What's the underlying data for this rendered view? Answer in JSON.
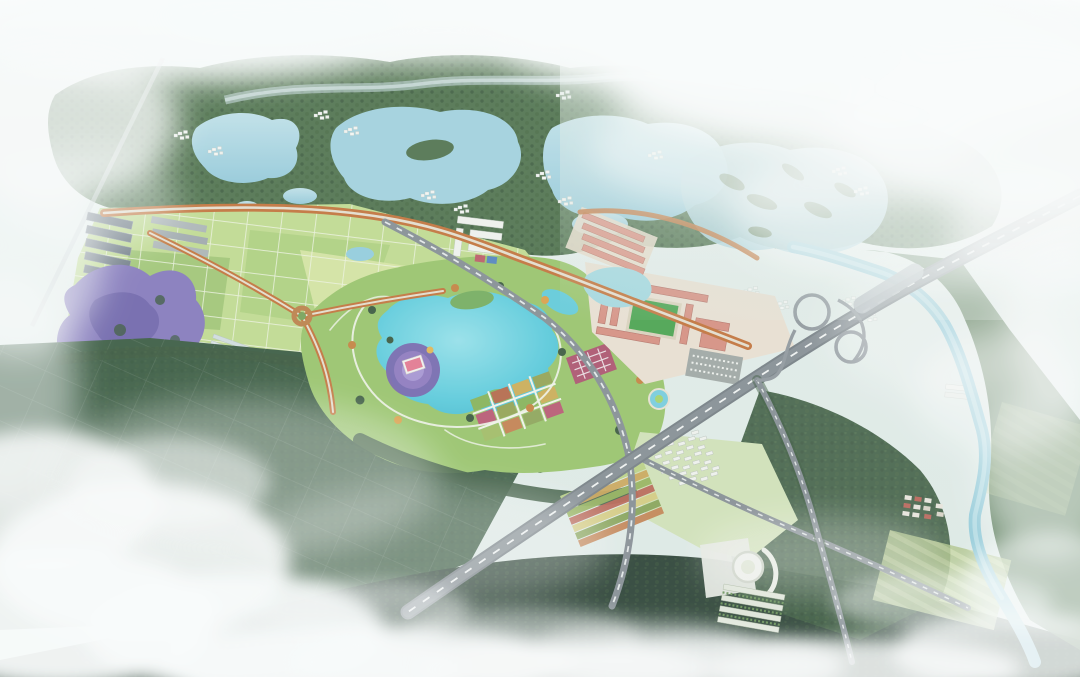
{
  "image": {
    "kind": "aerial-masterplan-rendering",
    "width": 1080,
    "height": 677,
    "visible_text": "none"
  },
  "palette": {
    "sky": "#e3eeea",
    "mist": "#f2f7f5",
    "cloud": "#fbfdfd",
    "forest": "#466b44",
    "forest_dark": "#2f4f33",
    "forest_light": "#679454",
    "field_light": "#bdd98a",
    "field_mid": "#a5ca74",
    "field_dark": "#2e5136",
    "lake_upper": "#9ccfdd",
    "lake_park": "#45c2d6",
    "river": "#8fc9d8",
    "road_gray": "#7e878d",
    "road_light": "#aeb6b8",
    "road_dash": "#f0f3f2",
    "tree_orange": "#bf6b2f",
    "plaza_purple": "#6f5ba8",
    "roof_pink": "#e2708a",
    "campus_roof": "#d4897a",
    "sports_green": "#3f9e44",
    "lavender": "#7e72b8",
    "building_white": "#eff1ed",
    "building_slate": "#67737e",
    "garden_red": "#a84a66",
    "garden_tan": "#c9a84c"
  },
  "scene": {
    "regions": [
      {
        "id": "mist-top",
        "label": "fog and mist band across top"
      },
      {
        "id": "upper-forest",
        "label": "forested hills with lakes"
      },
      {
        "id": "upper-lakes",
        "label": "three pale blue lakes"
      },
      {
        "id": "wetland",
        "label": "wetland estuary with islands (upper right)"
      },
      {
        "id": "cottages",
        "label": "scattered white cottage clusters"
      },
      {
        "id": "farmland",
        "label": "rectangular crop field grid"
      },
      {
        "id": "lavender-field",
        "label": "purple lavender flower field"
      },
      {
        "id": "industrial",
        "label": "slate-roofed building rows"
      },
      {
        "id": "greenhouses",
        "label": "pale greenhouse strips"
      },
      {
        "id": "central-park",
        "label": "central park with teal lake"
      },
      {
        "id": "visitor-center",
        "label": "pink-roofed building with purple circular plaza"
      },
      {
        "id": "garden-plots",
        "label": "colorful display garden parcels"
      },
      {
        "id": "campus",
        "label": "salmon campus buildings with sports field"
      },
      {
        "id": "residential",
        "label": "white residential cluster"
      },
      {
        "id": "stadium",
        "label": "round civic building"
      },
      {
        "id": "expressway",
        "label": "diagonal expressway"
      },
      {
        "id": "interchange",
        "label": "cloverleaf interchange"
      },
      {
        "id": "river",
        "label": "meandering river on the right"
      },
      {
        "id": "dark-fields",
        "label": "dark green fields lower left"
      },
      {
        "id": "clouds",
        "label": "white clouds over lower image"
      }
    ]
  }
}
